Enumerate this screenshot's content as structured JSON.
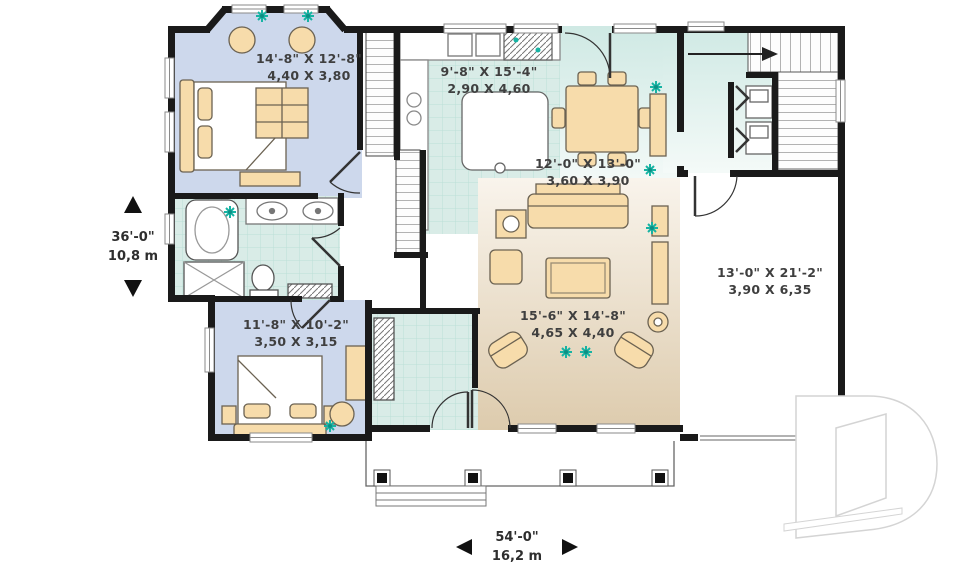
{
  "plan": {
    "rooms": {
      "bedroom1": {
        "imperial": "14'-8\" X 12'-8\"",
        "metric": "4,40 X 3,80"
      },
      "kitchen": {
        "imperial": "9'-8\" X 15'-4\"",
        "metric": "2,90 X 4,60"
      },
      "dining": {
        "imperial": "12'-0\" X 13'-0\"",
        "metric": "3,60 X 3,90"
      },
      "living": {
        "imperial": "15'-6\" X 14'-8\"",
        "metric": "4,65 X 4,40"
      },
      "garage": {
        "imperial": "13'-0\" X 21'-2\"",
        "metric": "3,90 X 6,35"
      },
      "bedroom2": {
        "imperial": "11'-8\" X 10'-2\"",
        "metric": "3,50 X 3,15"
      }
    },
    "overall": {
      "depth": {
        "imperial": "36'-0\"",
        "metric": "10,8 m"
      },
      "width": {
        "imperial": "54'-0\"",
        "metric": "16,2 m"
      }
    },
    "colors": {
      "wall": "#1a1a1a",
      "bedroom_floor": "#cdd8ec",
      "tile_floor": "#d9ece7",
      "wood_floor": "#ddcbad",
      "furniture": "#f7dcab",
      "plant": "#17b3a3",
      "watermark": "#d4d4d4"
    },
    "icons": {
      "plant": "8-point star",
      "dimension_arrow": "solid triangle",
      "watermark": "letter-D outline"
    }
  }
}
